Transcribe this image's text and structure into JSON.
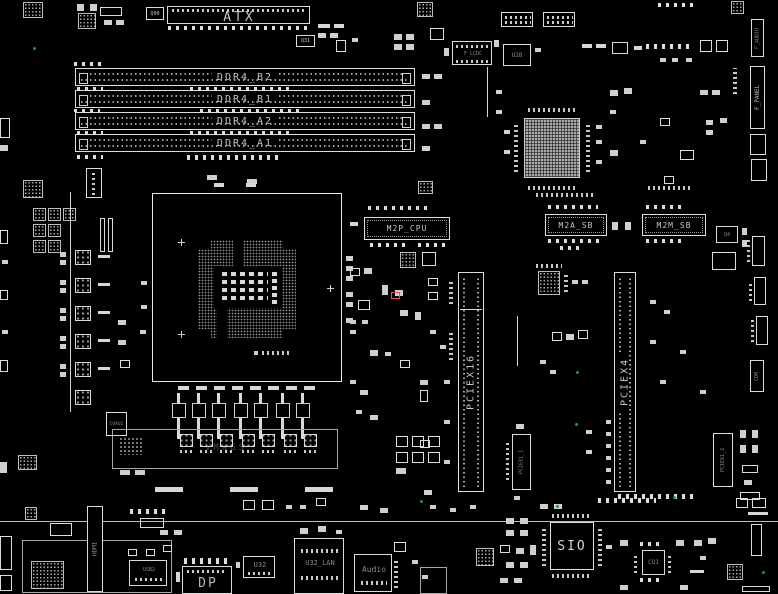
{
  "meta": {
    "type": "pcb-boardview-diagram"
  },
  "colors": {
    "background": "#000000",
    "silkscreen": "#dcdcdc",
    "dim_text": "#8a8a8a",
    "test_point_green": "#0e9d58",
    "highlight_red": "#e0506a",
    "chip_fill": "#a9a9a9"
  },
  "top": {
    "atx": "ATX",
    "q90": "Q90",
    "q31": "Q31",
    "f_lcdc": "F_LCDC",
    "u28": "U28"
  },
  "memory": {
    "slots": [
      {
        "label": "DDR4_B2"
      },
      {
        "label": "DDR4_B1"
      },
      {
        "label": "DDR4_A2"
      },
      {
        "label": "DDR4_A1"
      }
    ]
  },
  "m2": {
    "m2p_cpu": "M2P_CPU",
    "m2a_sb": "M2A_SB",
    "m2m_sb": "M2M_SB"
  },
  "pcie": {
    "x16": "PCIEX16",
    "x4": "PCIEX4",
    "x1_1": "PCIEX1_1",
    "x1_2": "PCIEX1_2"
  },
  "right_edge": {
    "f_audio": "F_AUDIO",
    "f_panel": "F_PANEL",
    "com": "COM",
    "q4": "Q4"
  },
  "vrm": {
    "faint_text": "VMaGS",
    "u1": "CVAU1"
  },
  "bottom": {
    "sio": "SIO",
    "cu1": "CU1"
  },
  "rear_io": {
    "hdmi": "HDMI",
    "dp": "DP",
    "usb2": "USB2",
    "u32": "U32",
    "u32_lan": "U32_LAN",
    "audio": "Audio"
  }
}
